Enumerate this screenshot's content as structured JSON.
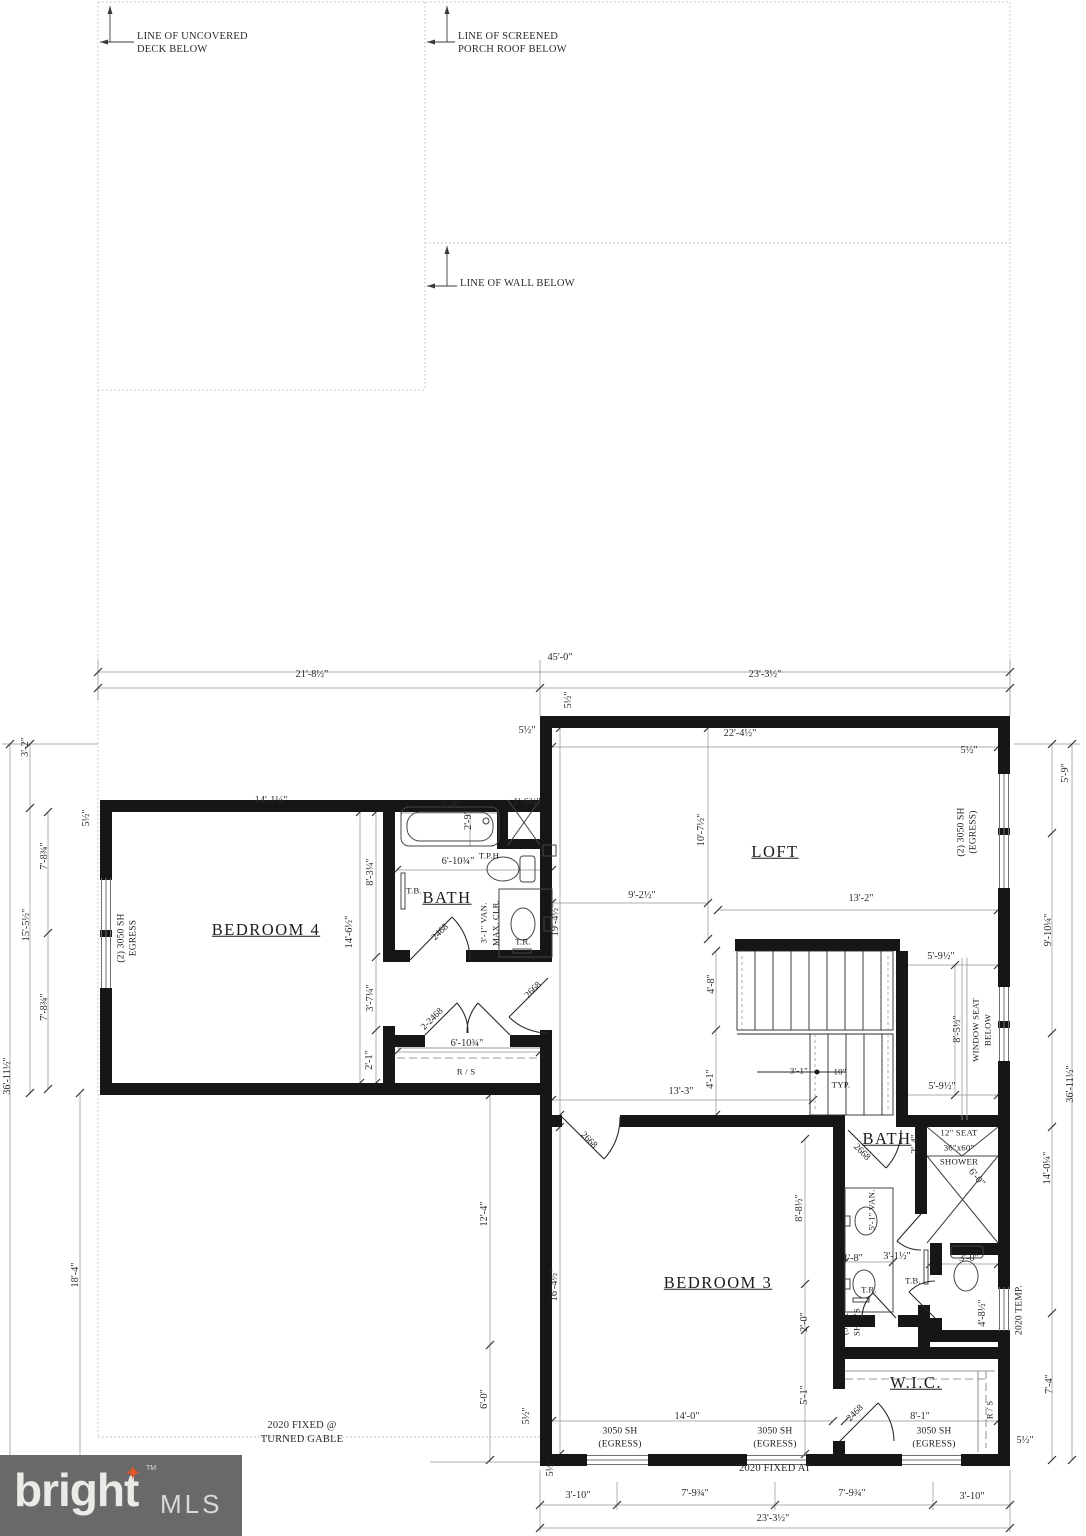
{
  "annotations": [
    {
      "name": "line-of-uncovered-deck-1",
      "text": "LINE OF UNCOVERED",
      "x": 137,
      "y": 37,
      "cls": "la"
    },
    {
      "name": "line-of-uncovered-deck-2",
      "text": "DECK BELOW",
      "x": 137,
      "y": 50,
      "cls": "la"
    },
    {
      "name": "line-of-screened-porch-1",
      "text": "LINE OF SCREENED",
      "x": 458,
      "y": 37,
      "cls": "la"
    },
    {
      "name": "line-of-screened-porch-2",
      "text": "PORCH ROOF BELOW",
      "x": 458,
      "y": 50,
      "cls": "la"
    },
    {
      "name": "line-of-wall-below",
      "text": "LINE OF WALL BELOW",
      "x": 460,
      "y": 284,
      "cls": "la"
    },
    {
      "name": "fixed-turned-gable-1",
      "text": "2020 FIXED @",
      "x": 302,
      "y": 1426
    },
    {
      "name": "fixed-turned-gable-2",
      "text": "TURNED GABLE",
      "x": 302,
      "y": 1440
    },
    {
      "name": "fixed-at-bottom",
      "text": "2020 FIXED AT",
      "x": 775,
      "y": 1469
    }
  ],
  "rooms": [
    {
      "name": "room-bedroom-4",
      "text": "BEDROOM 4",
      "x": 266,
      "y": 930
    },
    {
      "name": "room-bath-1",
      "text": "BATH",
      "x": 447,
      "y": 898
    },
    {
      "name": "room-loft",
      "text": "LOFT",
      "x": 775,
      "y": 852
    },
    {
      "name": "room-bedroom-3",
      "text": "BEDROOM 3",
      "x": 718,
      "y": 1283
    },
    {
      "name": "room-bath-2",
      "text": "BATH",
      "x": 887,
      "y": 1139
    },
    {
      "name": "room-wic",
      "text": "W.I.C.",
      "x": 916,
      "y": 1383
    }
  ],
  "windows": [
    {
      "name": "window-left-label-1",
      "text": "(2) 3050 SH",
      "x": 122,
      "y": 938,
      "rot": -90
    },
    {
      "name": "window-left-label-2",
      "text": "EGRESS",
      "x": 134,
      "y": 938,
      "rot": -90
    },
    {
      "name": "window-loft-label-1",
      "text": "(2) 3050 SH",
      "x": 962,
      "y": 832,
      "rot": -90
    },
    {
      "name": "window-loft-label-2",
      "text": "(EGRESS)",
      "x": 974,
      "y": 832,
      "rot": -90
    },
    {
      "name": "window-bottom1-label-1",
      "text": "3050 SH",
      "x": 620,
      "y": 1432
    },
    {
      "name": "window-bottom1-label-2",
      "text": "(EGRESS)",
      "x": 620,
      "y": 1445
    },
    {
      "name": "window-bottom2-label-1",
      "text": "3050 SH",
      "x": 775,
      "y": 1432
    },
    {
      "name": "window-bottom2-label-2",
      "text": "(EGRESS)",
      "x": 775,
      "y": 1445
    },
    {
      "name": "window-bottom3-label-1",
      "text": "3050 SH",
      "x": 934,
      "y": 1432
    },
    {
      "name": "window-bottom3-label-2",
      "text": "(EGRESS)",
      "x": 934,
      "y": 1445
    },
    {
      "name": "window-temp-label",
      "text": "2020 TEMP.",
      "x": 1020,
      "y": 1310,
      "rot": -90
    }
  ],
  "doors": [
    {
      "name": "door-bath1-label",
      "text": "2468",
      "x": 441,
      "y": 933,
      "rot": -45
    },
    {
      "name": "door-closet-label",
      "text": "2-2468",
      "x": 433,
      "y": 1020,
      "rot": -45
    },
    {
      "name": "door-hall-label",
      "text": "2668",
      "x": 534,
      "y": 991,
      "rot": -45
    },
    {
      "name": "door-bedroom3-label",
      "text": "2668",
      "x": 588,
      "y": 1141,
      "rot": 45
    },
    {
      "name": "door-bath2-label",
      "text": "2668",
      "x": 861,
      "y": 1153,
      "rot": 45
    },
    {
      "name": "door-wic-label",
      "text": "2468",
      "x": 856,
      "y": 1414,
      "rot": -45
    }
  ],
  "fixtures": [
    {
      "name": "tph-label",
      "text": "T.P.H",
      "x": 489,
      "y": 856
    },
    {
      "name": "towel-bar-1-label",
      "text": "T.B.",
      "x": 414,
      "y": 891
    },
    {
      "name": "vanity1-label-1",
      "text": "3'-1\" VAN.",
      "x": 484,
      "y": 923,
      "rot": -90
    },
    {
      "name": "vanity1-label-2",
      "text": "MAX. CLR.",
      "x": 496,
      "y": 923,
      "rot": -90
    },
    {
      "name": "towel-ring-1-label",
      "text": "T.R.",
      "x": 523,
      "y": 942
    },
    {
      "name": "rod-shelf-closet-label",
      "text": "R / S",
      "x": 466,
      "y": 1072
    },
    {
      "name": "shower-seat-label",
      "text": "12\" SEAT",
      "x": 959,
      "y": 1133
    },
    {
      "name": "shower-size-label",
      "text": "36\"x60\"",
      "x": 959,
      "y": 1148
    },
    {
      "name": "shower-label",
      "text": "SHOWER",
      "x": 959,
      "y": 1162
    },
    {
      "name": "vanity2-label",
      "text": "5'-1\" VAN.",
      "x": 872,
      "y": 1210,
      "rot": -90
    },
    {
      "name": "towel-ring-2-label",
      "text": "T.R.",
      "x": 869,
      "y": 1290
    },
    {
      "name": "towel-bar-2-label",
      "text": "T.B.",
      "x": 913,
      "y": 1281
    },
    {
      "name": "linen-shelves-label-1",
      "text": "(5) 12\"",
      "x": 845,
      "y": 1322,
      "rot": -90
    },
    {
      "name": "linen-shelves-label-2",
      "text": "SHLVS",
      "x": 857,
      "y": 1322,
      "rot": -90
    },
    {
      "name": "linen-closet-label",
      "text": "L.",
      "x": 903,
      "y": 1320,
      "cls": "big"
    },
    {
      "name": "rod-shelf-wic-top-label",
      "text": "R / S",
      "x": 878,
      "y": 1351
    },
    {
      "name": "rod-shelf-wic-right-label",
      "text": "R / S",
      "x": 990,
      "y": 1410,
      "rot": -90
    },
    {
      "name": "window-seat-label-1",
      "text": "WINDOW SEAT",
      "x": 976,
      "y": 1030,
      "rot": -90
    },
    {
      "name": "window-seat-label-2",
      "text": "BELOW",
      "x": 988,
      "y": 1030,
      "rot": -90
    },
    {
      "name": "stair-tread-label-1",
      "text": "10\"",
      "x": 840,
      "y": 1072
    },
    {
      "name": "stair-tread-label-2",
      "text": "TYP.",
      "x": 841,
      "y": 1085
    },
    {
      "name": "stair-width-label",
      "text": "3'-1\"",
      "x": 799,
      "y": 1071
    }
  ],
  "dimensions": [
    {
      "name": "dim-overall-width",
      "text": "45'-0\"",
      "x": 560,
      "y": 658
    },
    {
      "name": "dim-left-width",
      "text": "21'-8½\"",
      "x": 312,
      "y": 675
    },
    {
      "name": "dim-right-width",
      "text": "23'-3½\"",
      "x": 765,
      "y": 675
    },
    {
      "name": "dim-loft-width",
      "text": "22'-4½\"",
      "x": 740,
      "y": 734
    },
    {
      "name": "dim-wall-a",
      "text": "5½\"",
      "x": 527,
      "y": 731
    },
    {
      "name": "dim-wall-b",
      "text": "5½\"",
      "x": 569,
      "y": 700,
      "rot": -90
    },
    {
      "name": "dim-wall-c",
      "text": "5½\"",
      "x": 969,
      "y": 751
    },
    {
      "name": "dim-left-1",
      "text": "3'-2\"",
      "x": 26,
      "y": 747,
      "rot": -90
    },
    {
      "name": "dim-wall-d",
      "text": "5½\"",
      "x": 87,
      "y": 818,
      "rot": -90
    },
    {
      "name": "dim-left-2",
      "text": "7'-8¾\"",
      "x": 45,
      "y": 856,
      "rot": -90
    },
    {
      "name": "dim-left-3",
      "text": "15'-5½\"",
      "x": 27,
      "y": 925,
      "rot": -90
    },
    {
      "name": "dim-left-4",
      "text": "7'-8¾\"",
      "x": 45,
      "y": 1007,
      "rot": -90
    },
    {
      "name": "dim-left-overall",
      "text": "36'-11½\"",
      "x": 8,
      "y": 1076,
      "rot": -90
    },
    {
      "name": "dim-left-5",
      "text": "18'-4\"",
      "x": 76,
      "y": 1275,
      "rot": -90
    },
    {
      "name": "dim-right-1",
      "text": "5'-9\"",
      "x": 1066,
      "y": 773,
      "rot": -90
    },
    {
      "name": "dim-right-2",
      "text": "9'-10¼\"",
      "x": 1049,
      "y": 930,
      "rot": -90
    },
    {
      "name": "dim-right-overall",
      "text": "36'-11½\"",
      "x": 1071,
      "y": 1084,
      "rot": -90
    },
    {
      "name": "dim-right-3",
      "text": "14'-0¼\"",
      "x": 1048,
      "y": 1168,
      "rot": -90
    },
    {
      "name": "dim-right-4",
      "text": "7'-4\"",
      "x": 1050,
      "y": 1384,
      "rot": -90
    },
    {
      "name": "dim-bottom-1",
      "text": "3'-10\"",
      "x": 578,
      "y": 1496
    },
    {
      "name": "dim-bottom-2",
      "text": "7'-9¾\"",
      "x": 695,
      "y": 1494
    },
    {
      "name": "dim-bottom-3",
      "text": "7'-9¾\"",
      "x": 852,
      "y": 1494
    },
    {
      "name": "dim-bottom-4",
      "text": "3'-10\"",
      "x": 972,
      "y": 1497
    },
    {
      "name": "dim-bottom-overall",
      "text": "23'-3½\"",
      "x": 773,
      "y": 1519
    },
    {
      "name": "dim-wall-e",
      "text": "5½\"",
      "x": 551,
      "y": 1468,
      "rot": -90
    },
    {
      "name": "dim-wall-f",
      "text": "5½\"",
      "x": 1025,
      "y": 1441
    },
    {
      "name": "dim-bd4-width",
      "text": "14'-1¼\"",
      "x": 271,
      "y": 801
    },
    {
      "name": "dim-tub-length",
      "text": "5'-0\"",
      "x": 451,
      "y": 806
    },
    {
      "name": "dim-tub-width",
      "text": "2'-9\"",
      "x": 469,
      "y": 820,
      "rot": -90
    },
    {
      "name": "dim-linen1",
      "text": "1'-6¾\"",
      "x": 527,
      "y": 803
    },
    {
      "name": "dim-bd4-a",
      "text": "8'-3¼\"",
      "x": 371,
      "y": 872,
      "rot": -90
    },
    {
      "name": "dim-bd4-height",
      "text": "14'-6½\"",
      "x": 350,
      "y": 932,
      "rot": -90
    },
    {
      "name": "dim-bath1-width",
      "text": "6'-10¾\"",
      "x": 458,
      "y": 862
    },
    {
      "name": "dim-bd4-b",
      "text": "3'-7¼\"",
      "x": 371,
      "y": 998,
      "rot": -90
    },
    {
      "name": "dim-bd4-c",
      "text": "2'-1\"",
      "x": 370,
      "y": 1060,
      "rot": -90
    },
    {
      "name": "dim-closet-width",
      "text": "6'-10¾\"",
      "x": 467,
      "y": 1044
    },
    {
      "name": "dim-loft-depth",
      "text": "10'-7½\"",
      "x": 702,
      "y": 830,
      "rot": -90
    },
    {
      "name": "dim-hall-width",
      "text": "9'-2½\"",
      "x": 642,
      "y": 896
    },
    {
      "name": "dim-hall-height",
      "text": "19'-4½\"",
      "x": 556,
      "y": 920,
      "rot": -90
    },
    {
      "name": "dim-stair-width",
      "text": "13'-2\"",
      "x": 861,
      "y": 899
    },
    {
      "name": "dim-stair-a",
      "text": "4'-8\"",
      "x": 712,
      "y": 984,
      "rot": -90
    },
    {
      "name": "dim-seat-top",
      "text": "5'-9½\"",
      "x": 941,
      "y": 957
    },
    {
      "name": "dim-seat-side",
      "text": "8'-5½\"",
      "x": 958,
      "y": 1029,
      "rot": -90
    },
    {
      "name": "dim-stair-b",
      "text": "4'-1\"",
      "x": 711,
      "y": 1079,
      "rot": -90
    },
    {
      "name": "dim-seat-bottom",
      "text": "5'-9½\"",
      "x": 942,
      "y": 1087
    },
    {
      "name": "dim-hall-bottom",
      "text": "13'-3\"",
      "x": 681,
      "y": 1092
    },
    {
      "name": "dim-lower-left-a",
      "text": "12'-4\"",
      "x": 485,
      "y": 1214,
      "rot": -90
    },
    {
      "name": "dim-lower-left-b",
      "text": "6'-0\"",
      "x": 485,
      "y": 1399,
      "rot": -90
    },
    {
      "name": "dim-bd3-height",
      "text": "16'-4½\"",
      "x": 555,
      "y": 1285,
      "rot": -90
    },
    {
      "name": "dim-wall-g",
      "text": "5½\"",
      "x": 527,
      "y": 1416,
      "rot": -90
    },
    {
      "name": "dim-bd3-a",
      "text": "8'-8½\"",
      "x": 800,
      "y": 1208,
      "rot": -90
    },
    {
      "name": "dim-bd3-b",
      "text": "2'-0\"",
      "x": 805,
      "y": 1322,
      "rot": -90
    },
    {
      "name": "dim-bd3-c",
      "text": "5'-1\"",
      "x": 805,
      "y": 1395,
      "rot": -90
    },
    {
      "name": "dim-shower-a",
      "text": "2'-4\"",
      "x": 916,
      "y": 1144,
      "rot": -90
    },
    {
      "name": "dim-shower-b",
      "text": "6'-0\"",
      "x": 976,
      "y": 1178,
      "rot": 50
    },
    {
      "name": "dim-sink",
      "text": "1'-8\"",
      "x": 853,
      "y": 1259
    },
    {
      "name": "dim-van-clr",
      "text": "3'-1½\"",
      "x": 897,
      "y": 1257
    },
    {
      "name": "dim-toilet-room",
      "text": "3'-0\"",
      "x": 969,
      "y": 1259
    },
    {
      "name": "dim-toilet-depth",
      "text": "4'-8½\"",
      "x": 983,
      "y": 1313,
      "rot": -90
    },
    {
      "name": "dim-bd3-width",
      "text": "14'-0\"",
      "x": 687,
      "y": 1417
    },
    {
      "name": "dim-wic-width",
      "text": "8'-1\"",
      "x": 920,
      "y": 1417
    }
  ],
  "logo": {
    "brand": "bright",
    "star": "✦",
    "tm": "TM",
    "suffix": "MLS"
  }
}
